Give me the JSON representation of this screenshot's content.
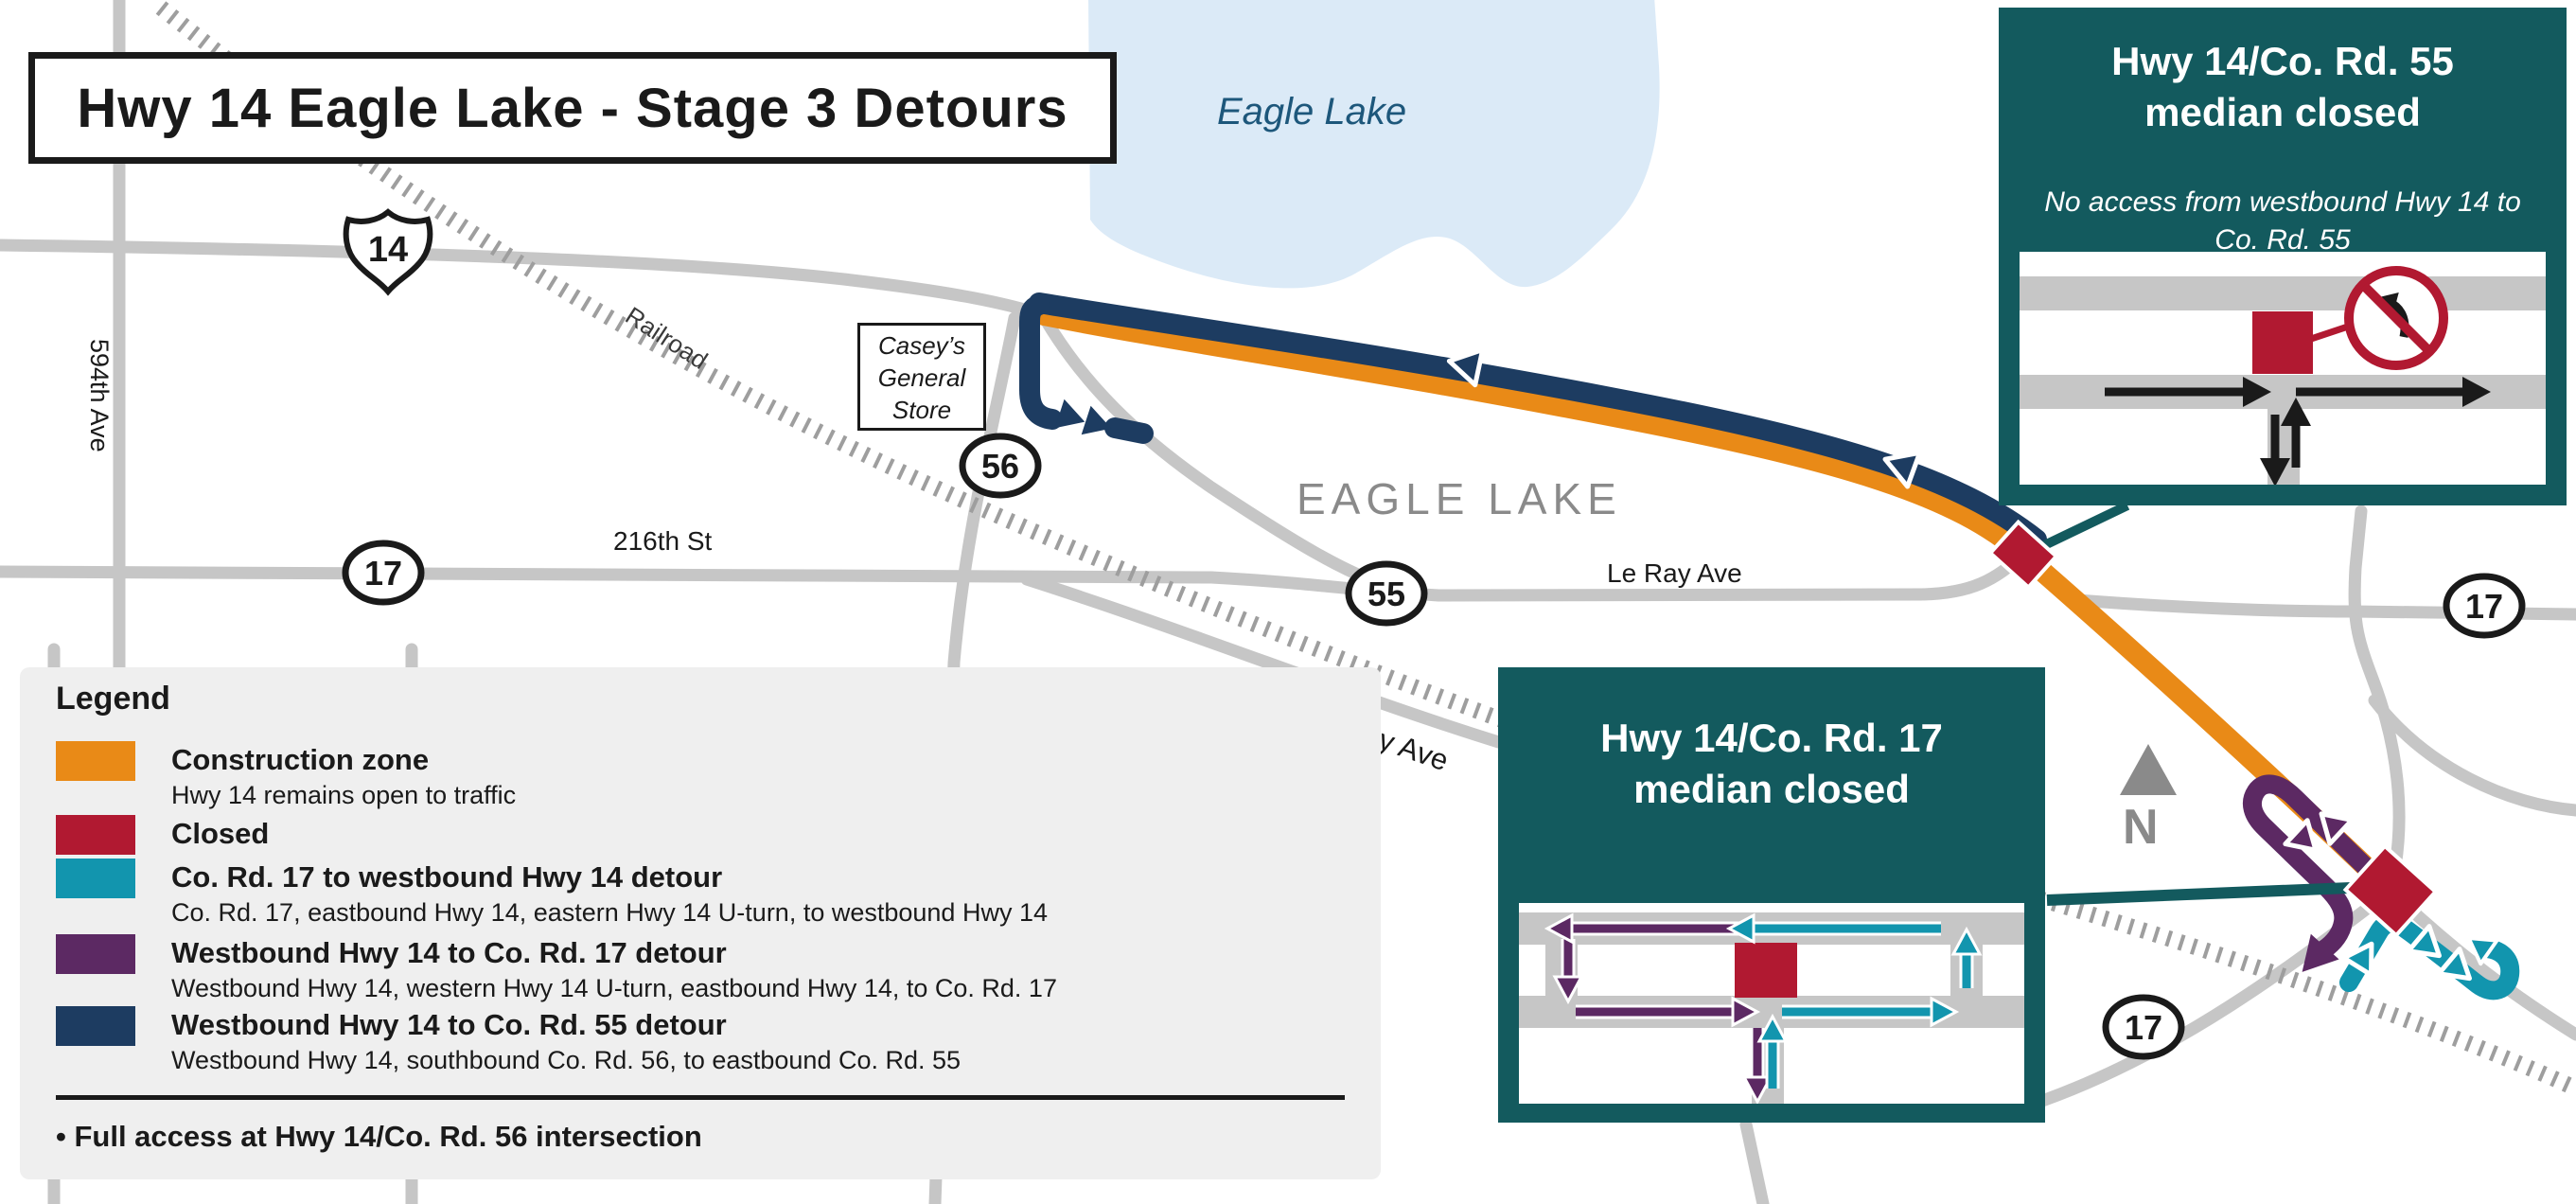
{
  "title": "Hwy 14 Eagle Lake - Stage 3 Detours",
  "map": {
    "lake_name": "Eagle Lake",
    "city_name": "EAGLE LAKE",
    "railroad_label": "Railroad",
    "north_label": "N",
    "streets": {
      "ave594": "594th Ave",
      "st216": "216th St",
      "leray": "Le Ray Ave",
      "parkway": "Parkway Ave"
    },
    "store": {
      "line1": "Casey’s",
      "line2": "General",
      "line3": "Store"
    },
    "shields": {
      "hwy14": "14",
      "co56": "56",
      "co55": "55",
      "co17": "17"
    }
  },
  "legend": {
    "heading": "Legend",
    "items": [
      {
        "label": "Construction zone",
        "sub": "Hwy 14 remains open to traffic",
        "color": "#E98A17"
      },
      {
        "label": "Closed",
        "sub": "",
        "color": "#B11931"
      },
      {
        "label": "Co. Rd. 17 to westbound Hwy 14 detour",
        "sub": "Co. Rd. 17, eastbound Hwy 14, eastern Hwy 14 U-turn, to westbound Hwy 14",
        "color": "#1295AE"
      },
      {
        "label": "Westbound Hwy 14 to Co. Rd. 17 detour",
        "sub": "Westbound Hwy 14, western Hwy 14 U-turn, eastbound Hwy 14, to Co. Rd. 17",
        "color": "#5C2963"
      },
      {
        "label": "Westbound Hwy 14 to Co. Rd. 55 detour",
        "sub": "Westbound Hwy 14, southbound Co. Rd. 56, to eastbound Co. Rd. 55",
        "color": "#1D3C61"
      }
    ],
    "note": "• Full access at Hwy 14/Co. Rd. 56 intersection"
  },
  "callouts": {
    "rd55": {
      "title1": "Hwy 14/Co. Rd. 55",
      "title2": "median closed",
      "body": "No access from westbound Hwy 14 to Co. Rd. 55"
    },
    "rd17": {
      "title1": "Hwy 14/Co. Rd. 17",
      "title2": "median closed"
    }
  },
  "colors": {
    "construction_orange": "#E98A17",
    "closed_red": "#B11931",
    "detour_teal": "#1295AE",
    "detour_purple": "#5C2963",
    "detour_navy": "#1D3C61",
    "callout_teal": "#135A5E",
    "lake_blue": "#DBEAF7",
    "road_gray": "#C6C6C6",
    "railroad_gray": "#9E9E9E"
  }
}
